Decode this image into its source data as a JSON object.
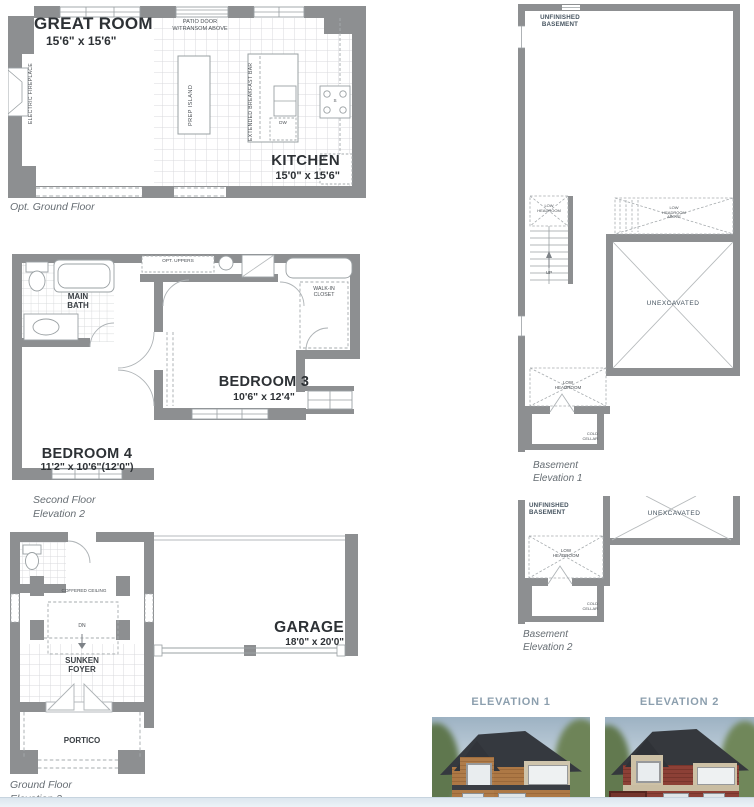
{
  "colors": {
    "wall": "#8d8f91",
    "thin_line": "#9aa0a3",
    "caption_text": "#666d73",
    "elevation_title": "#8c9fae",
    "basement_label": "#45535f"
  },
  "opt_ground": {
    "great_room": "GREAT ROOM",
    "great_room_dims": "15'6\" x 15'6\"",
    "kitchen": "KITCHEN",
    "kitchen_dims": "15'0\" x 15'6\"",
    "patio_door": "PATIO DOOR\nW/TRANSOM ABOVE",
    "electric_fireplace": "ELECTRIC FIREPLACE",
    "prep_island": "PREP ISLAND",
    "breakfast_bar": "EXTENDED BREAKFAST BAR",
    "dishwasher": "DW",
    "stove": "S",
    "fridge": "F",
    "caption": "Opt. Ground Floor"
  },
  "second_floor": {
    "main_bath": "MAIN\nBATH",
    "opt_uppers": "OPT. UPPERS",
    "walk_in_closet": "WALK-IN\nCLOSET",
    "bedroom3": "BEDROOM 3",
    "bedroom3_dims": "10'6\" x 12'4\"",
    "bedroom4": "BEDROOM 4",
    "bedroom4_dims": "11'2\" x 10'6\"(12'0\")",
    "caption": "Second Floor\nElevation 2"
  },
  "ground_floor": {
    "coffered_ceiling": "COFFERED CEILING",
    "dn": "DN",
    "sunken_foyer": "SUNKEN\nFOYER",
    "portico": "PORTICO",
    "garage": "GARAGE",
    "garage_dims": "18'0\" x 20'0\"",
    "caption": "Ground Floor\nElevation 2"
  },
  "basement1": {
    "unfinished": "UNFINISHED\nBASEMENT",
    "low_headroom_stairs": "LOW\nHEADROOM",
    "low_headroom_above": "LOW\nHEADROOM\nABOVE",
    "up": "UP",
    "unexcavated": "UNEXCAVATED",
    "low_headroom": "LOW\nHEADROOM",
    "cold_cellar": "COLD\nCELLAR",
    "caption": "Basement\nElevation 1"
  },
  "basement2": {
    "unfinished": "UNFINISHED\nBASEMENT",
    "unexcavated": "UNEXCAVATED",
    "low_headroom": "LOW\nHEADROOM",
    "cold_cellar": "COLD\nCELLAR",
    "caption": "Basement\nElevation 2"
  },
  "elevations": [
    {
      "title": "ELEVATION 1"
    },
    {
      "title": "ELEVATION 2"
    }
  ]
}
